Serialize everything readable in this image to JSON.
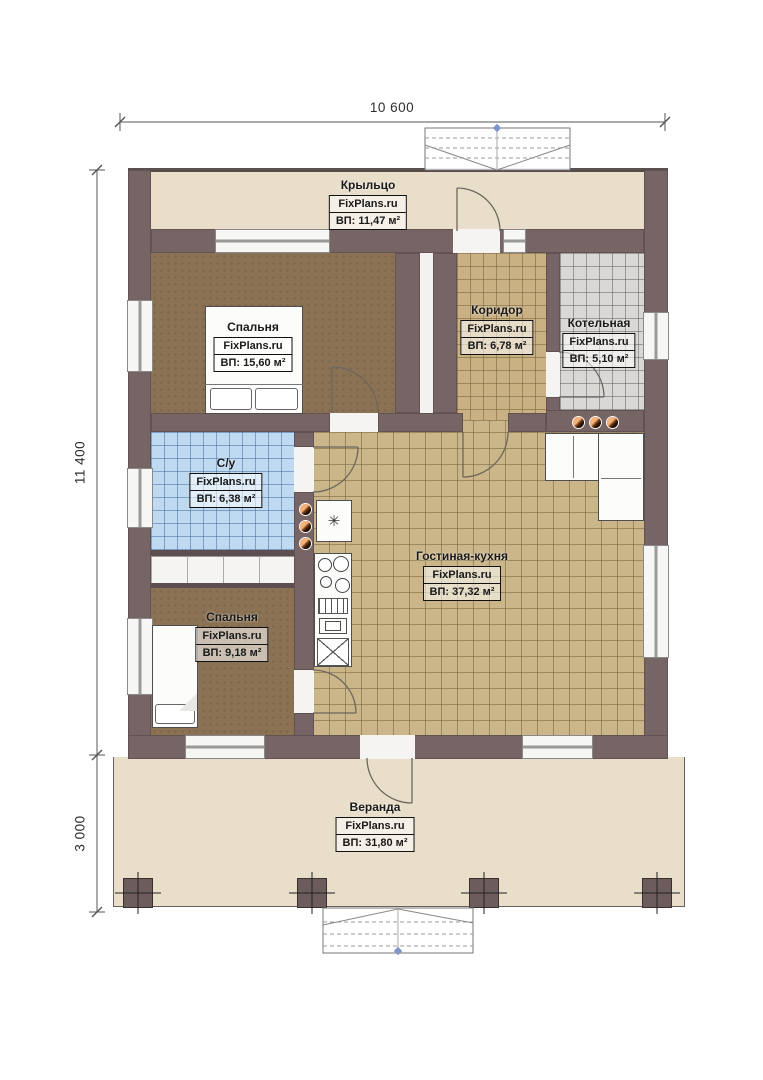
{
  "brand": "FixPlans.ru",
  "dimensions": {
    "top": "10 600",
    "side_main": "11 400",
    "side_veranda": "3 000"
  },
  "rooms": {
    "porch": {
      "name": "Крыльцо",
      "area": "ВП: 11,47 м²"
    },
    "bedroom1": {
      "name": "Спальня",
      "area": "ВП: 15,60 м²"
    },
    "corridor": {
      "name": "Коридор",
      "area": "ВП: 6,78 м²"
    },
    "boiler": {
      "name": "Котельная",
      "area": "ВП: 5,10 м²"
    },
    "bathroom": {
      "name": "С/у",
      "area": "ВП: 6,38 м²"
    },
    "living": {
      "name": "Гостиная-кухня",
      "area": "ВП: 37,32 м²"
    },
    "bedroom2": {
      "name": "Спальня",
      "area": "ВП: 9,18 м²"
    },
    "veranda": {
      "name": "Веранда",
      "area": "ВП: 31,80 м²"
    }
  },
  "icons": {
    "fridge": "✳"
  },
  "colors": {
    "wall": "#776565",
    "porch_floor": "#e8deca",
    "bedroom_floor": "#8b7254",
    "corridor_floor": "#c9b183",
    "boiler_floor": "#d9d8d6",
    "bathroom_floor": "#bfdaf0",
    "living_floor": "#cbb68a",
    "accent_dot": "#f5b27a"
  }
}
